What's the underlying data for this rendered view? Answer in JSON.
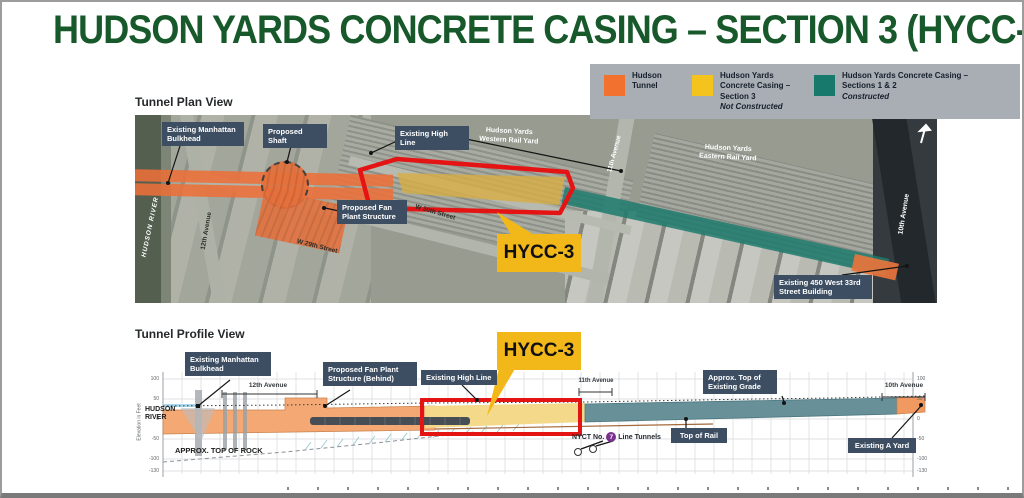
{
  "title": "HUDSON YARDS CONCRETE CASING – SECTION 3 (HYCC-3)",
  "legend": {
    "items": [
      {
        "label": "Hudson Tunnel",
        "status": "",
        "color": "#f2712e"
      },
      {
        "label": "Hudson Yards Concrete Casing – Section 3",
        "status": "Not Constructed",
        "color": "#f5c31d"
      },
      {
        "label": "Hudson Yards Concrete Casing – Sections 1 & 2",
        "status": "Constructed",
        "color": "#17796b"
      }
    ]
  },
  "plan": {
    "heading": "Tunnel Plan View",
    "callout": "HYCC-3",
    "labels": {
      "bulkhead": "Existing Manhattan Bulkhead",
      "shaft": "Proposed Shaft",
      "high_line": "Existing High Line",
      "fan_plant": "Proposed Fan Plant Structure",
      "building_450": "Existing 450 West 33rd Street Building"
    },
    "map_texts": {
      "western_yard": "Hudson Yards Western Rail Yard",
      "eastern_yard": "Hudson Yards Eastern Rail Yard",
      "hudson_river": "HUDSON RIVER",
      "ave_12": "12th Avenue",
      "ave_11": "11th Avenue",
      "ave_10": "10th Avenue",
      "st_29": "W 29th Street",
      "st_30": "W 30th Street"
    }
  },
  "profile": {
    "heading": "Tunnel Profile View",
    "callout": "HYCC-3",
    "labels": {
      "bulkhead": "Existing Manhattan Bulkhead",
      "fan_plant": "Proposed Fan Plant Structure (Behind)",
      "high_line": "Existing High Line",
      "grade": "Approx. Top of Existing Grade",
      "top_of_rail": "Top of Rail",
      "a_yard": "Existing A Yard"
    },
    "texts": {
      "hudson_river": "HUDSON RIVER",
      "top_of_rock": "APPROX. TOP OF ROCK",
      "nyct_prefix": "NYCT No.",
      "nyct_badge": "7",
      "nyct_suffix": "Line Tunnels",
      "ave_12": "12th Avenue",
      "ave_11": "11th Avenue",
      "ave_10": "10th Avenue",
      "axis_label": "Elevation in Feet"
    },
    "axis": {
      "ticks": [
        "100",
        "50",
        "0",
        "-50",
        "-100",
        "-130"
      ]
    }
  }
}
